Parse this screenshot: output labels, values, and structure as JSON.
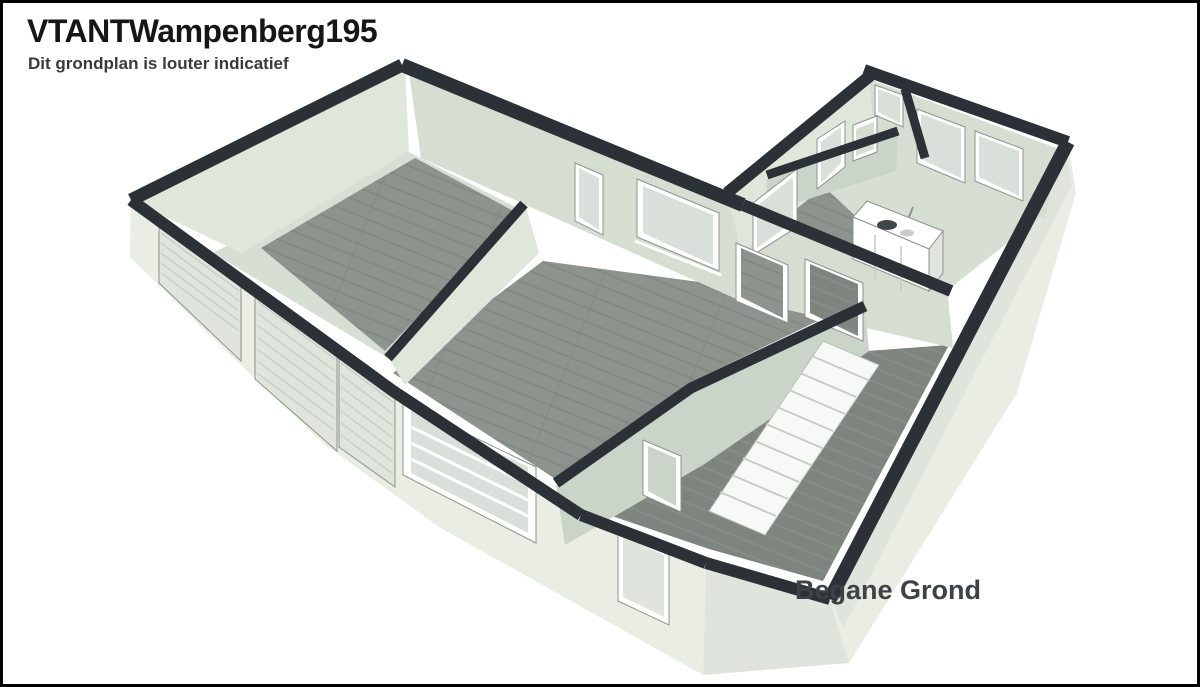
{
  "header": {
    "title": "VTANTWampenberg195",
    "subtitle": "Dit grondplan is louter indicatief"
  },
  "plan": {
    "floor_label": "Begane Grond",
    "view": "3d-floorplan-render"
  },
  "colors": {
    "border": "#000000",
    "title-color": "#161616",
    "subtitle-color": "#3a3a3a",
    "label-color": "#3e4245",
    "cap": "#2b3136",
    "ext": "#e9ede4",
    "ext2": "#dfe5dc",
    "face-light": "#dfe6da",
    "face-mid": "#d6ded2",
    "face-dark": "#cbd4c9",
    "wood": "#8d938d",
    "wood2": "#7e847e",
    "concrete": "#d7ded4",
    "glass": "#d9e0d9",
    "frame-white": "#ffffff",
    "frame-stroke": "#8d948b",
    "steps": "#f7f9f6",
    "step-edge": "#c6cec4"
  }
}
